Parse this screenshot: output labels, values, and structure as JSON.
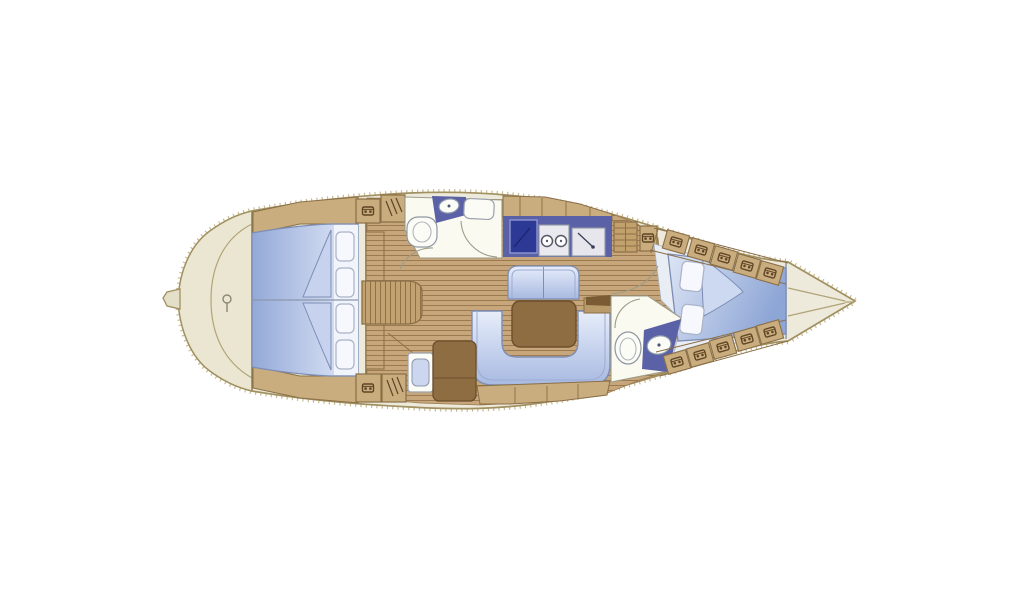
{
  "diagram": {
    "kind": "sailing-yacht-interior-floorplan",
    "orientation": "bow-left-stern-right",
    "rooms": [
      {
        "id": "foredeck",
        "label": "foredeck-anchor-area"
      },
      {
        "id": "forward-cabin",
        "label": "forward-double-berth-cabin"
      },
      {
        "id": "forward-head",
        "label": "forward-bathroom"
      },
      {
        "id": "saloon",
        "label": "saloon-with-u-sofa-and-table"
      },
      {
        "id": "galley",
        "label": "galley-with-stove-and-sinks"
      },
      {
        "id": "nav-station",
        "label": "chart-table-with-seat"
      },
      {
        "id": "aft-head",
        "label": "aft-bathroom"
      },
      {
        "id": "aft-cabin",
        "label": "aft-double-berth-cabin"
      },
      {
        "id": "stern",
        "label": "stern-cone"
      }
    ],
    "features": {
      "forward_pillows": 4,
      "aft_pillows": 2,
      "stern_locker_hatches_upper": 5,
      "stern_locker_hatches_lower": 5,
      "galley_burners": 2
    }
  },
  "colors": {
    "background": "#ffffff",
    "hull_deck": "#eeeadb",
    "bow_deck": "#eae6d2",
    "hull_outline": "#a19060",
    "hatch_tick": "#c8bc93",
    "wood_floor": "#c6a67a",
    "cabinet_wood": "#c9ad7e",
    "cabinet_outline": "#8a6f47",
    "steps_wood": "#c2a16d",
    "counter_blue": "#5a61a6",
    "stove_blue": "#2c3a96",
    "table_brown": "#8f6d42",
    "table_outline": "#6b4e2a",
    "room_white": "#fafaf1",
    "aft_cabin_floor": "#e9edf4",
    "fixture_white": "#fcfcf6",
    "fixture_outline": "#9097a3",
    "upholstery_outline": "#7d8db4",
    "pillow_white": "#f6f8fd",
    "glyph_brown": "#5f4526",
    "dark_wedge": "#7b5b33"
  }
}
